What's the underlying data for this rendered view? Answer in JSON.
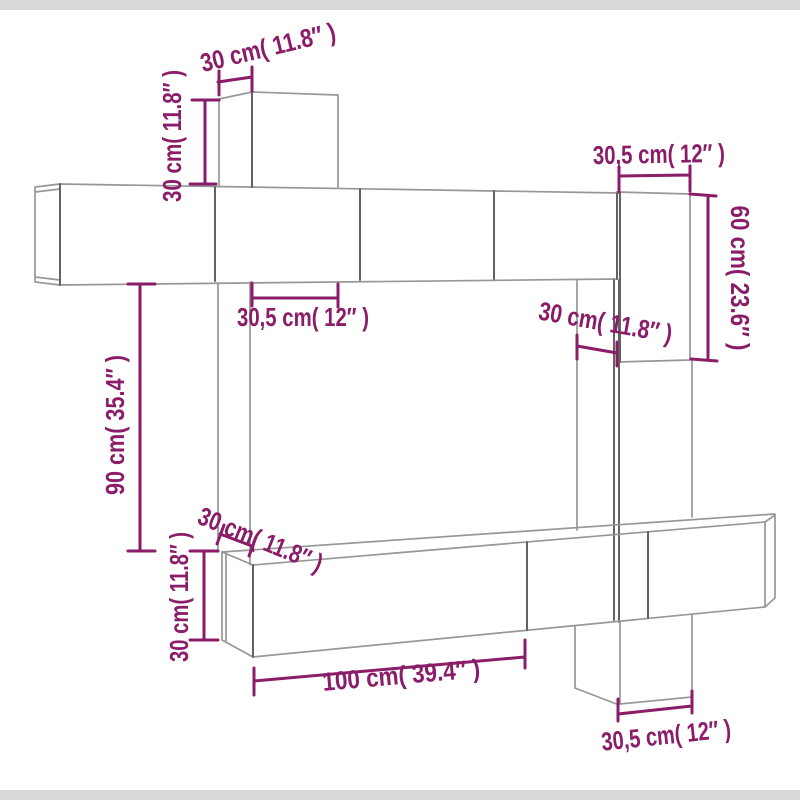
{
  "page": {
    "kind": "furniture-dimension-diagram",
    "background": "#ffffff"
  },
  "colors": {
    "dimension_color": "#8a1c68",
    "outline_color": "#979797",
    "outline_dark_color": "#626262",
    "band_color": "#d9d9d9",
    "background": "#ffffff"
  },
  "annotations": [
    {
      "id": "top-box-width",
      "text": "30 cm( 11.8″ )"
    },
    {
      "id": "top-box-height",
      "text": "30 cm( 11.8″ )"
    },
    {
      "id": "top-right-width",
      "text": "30,5 cm( 12″ )"
    },
    {
      "id": "right-height",
      "text": "60 cm( 23.6″ )"
    },
    {
      "id": "mid-width",
      "text": "30,5 cm( 12″ )"
    },
    {
      "id": "mid-right-width",
      "text": "30 cm( 11.8″ )"
    },
    {
      "id": "left-height",
      "text": "90 cm( 35.4″ )"
    },
    {
      "id": "bottom-left-depth",
      "text": "30 cm( 11.8″ )"
    },
    {
      "id": "bottom-left-height",
      "text": "30 cm( 11.8″ )"
    },
    {
      "id": "bottom-width",
      "text": "100 cm( 39.4″ )"
    },
    {
      "id": "bottom-right-width",
      "text": "30,5 cm( 12″ )"
    }
  ]
}
